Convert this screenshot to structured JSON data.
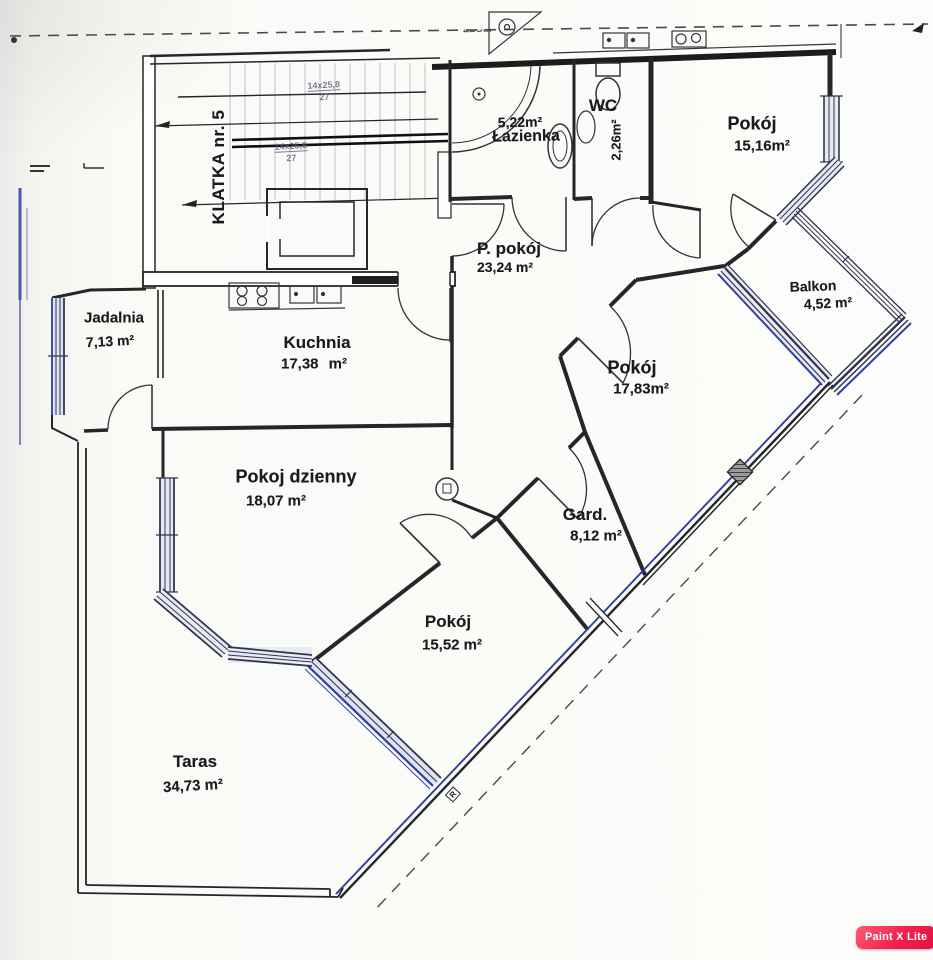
{
  "app": {
    "badge_label": "Paint X Lite"
  },
  "floorplan": {
    "stairwell": {
      "label": "KLATKA nr. 5",
      "flights": [
        {
          "steps": "14x25,8",
          "rise": "27"
        },
        {
          "steps": "14x25,8",
          "rise": "27"
        }
      ]
    },
    "rooms": [
      {
        "id": "lazienka",
        "name": "Łazienka",
        "area": "5,22m²"
      },
      {
        "id": "wc",
        "name": "WC",
        "area": "2,26m²"
      },
      {
        "id": "pokoj-1",
        "name": "Pokój",
        "area": "15,16m²"
      },
      {
        "id": "balkon",
        "name": "Balkon",
        "area": "4,52 m²"
      },
      {
        "id": "p-pokoj",
        "name": "P. pokój",
        "area": "23,24 m²"
      },
      {
        "id": "pokoj-2",
        "name": "Pokój",
        "area": "17,83m²"
      },
      {
        "id": "jadalnia",
        "name": "Jadalnia",
        "area": "7,13 m²"
      },
      {
        "id": "kuchnia",
        "name": "Kuchnia",
        "area": "17,38 m²"
      },
      {
        "id": "pokoj-dzienny",
        "name": "Pokoj dzienny",
        "area": "18,07 m²"
      },
      {
        "id": "gard",
        "name": "Gard.",
        "area": "8,12 m²"
      },
      {
        "id": "pokoj-3",
        "name": "Pokój",
        "area": "15,52 m²"
      },
      {
        "id": "taras",
        "name": "Taras",
        "area": "34,73 m²"
      }
    ],
    "markers": {
      "radiator": "R",
      "illegible_top_fragment": "ZŁObI"
    },
    "colors": {
      "wall": "#26262a",
      "window_accent_blue": "#2f3fa0",
      "window_fill": "#e7eaf2",
      "paper": "#fafaf7",
      "badge_red": "#ef1e4d"
    }
  }
}
